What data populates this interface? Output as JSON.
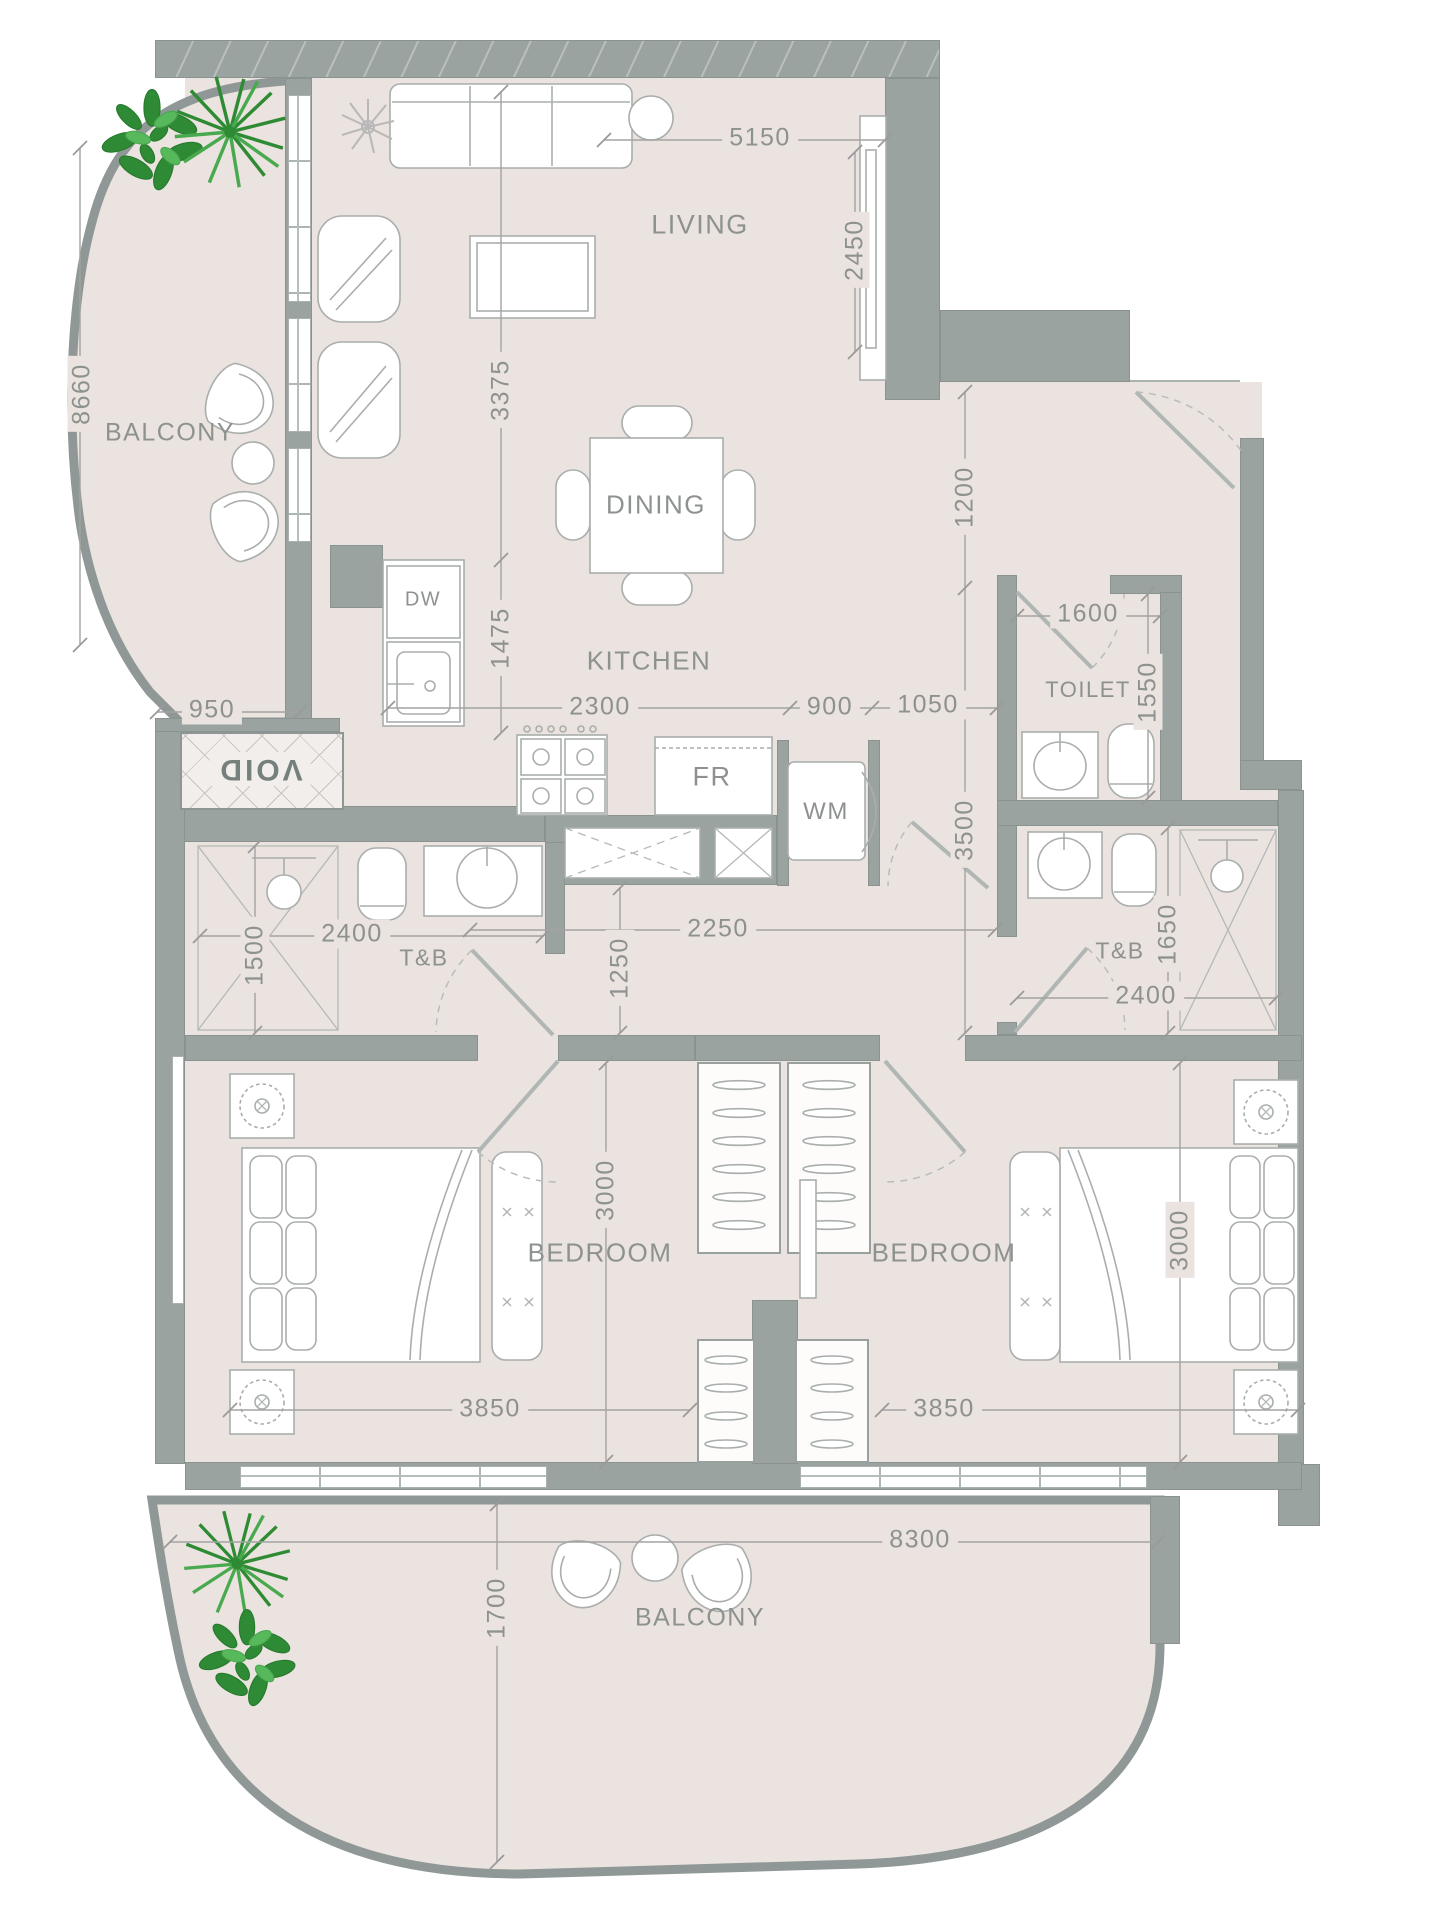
{
  "rooms": {
    "balcony_top": "BALCONY",
    "living": "LIVING",
    "dining": "DINING",
    "kitchen": "KITCHEN",
    "toilet": "TOILET",
    "tb_left": "T&B",
    "tb_right": "T&B",
    "bedroom_left": "BEDROOM",
    "bedroom_right": "BEDROOM",
    "balcony_bottom": "BALCONY",
    "void": "VOID"
  },
  "appliances": {
    "dw": "DW",
    "fr": "FR",
    "wm": "WM"
  },
  "dimensions": {
    "top_living_width": "5150",
    "living_depth": "2450",
    "balcony_left_length": "8660",
    "living_left_height": "3375",
    "kitchen_left_height": "1475",
    "entry_upper": "1200",
    "entry_lower": "3500",
    "kitchen_width": "2300",
    "kitchen_pass": "900",
    "hall_width": "1050",
    "toilet_width": "1600",
    "toilet_depth": "1550",
    "balcony_top_bottom": "950",
    "tb_left_width": "2400",
    "tb_left_depth": "1500",
    "corridor_width": "2250",
    "corridor_depth": "1250",
    "tb_right_depth": "1650",
    "tb_right_width": "2400",
    "bedroom_left_depth": "3000",
    "bedroom_left_width": "3850",
    "bedroom_right_depth": "3000",
    "bedroom_right_width": "3850",
    "balcony_bottom_width": "8300",
    "balcony_bottom_depth": "1700"
  },
  "colors": {
    "wall": "#9aa3a0",
    "floor": "#eae3df",
    "text": "#8d928f",
    "plant_dark": "#267a2c",
    "plant_light": "#49a94e"
  }
}
